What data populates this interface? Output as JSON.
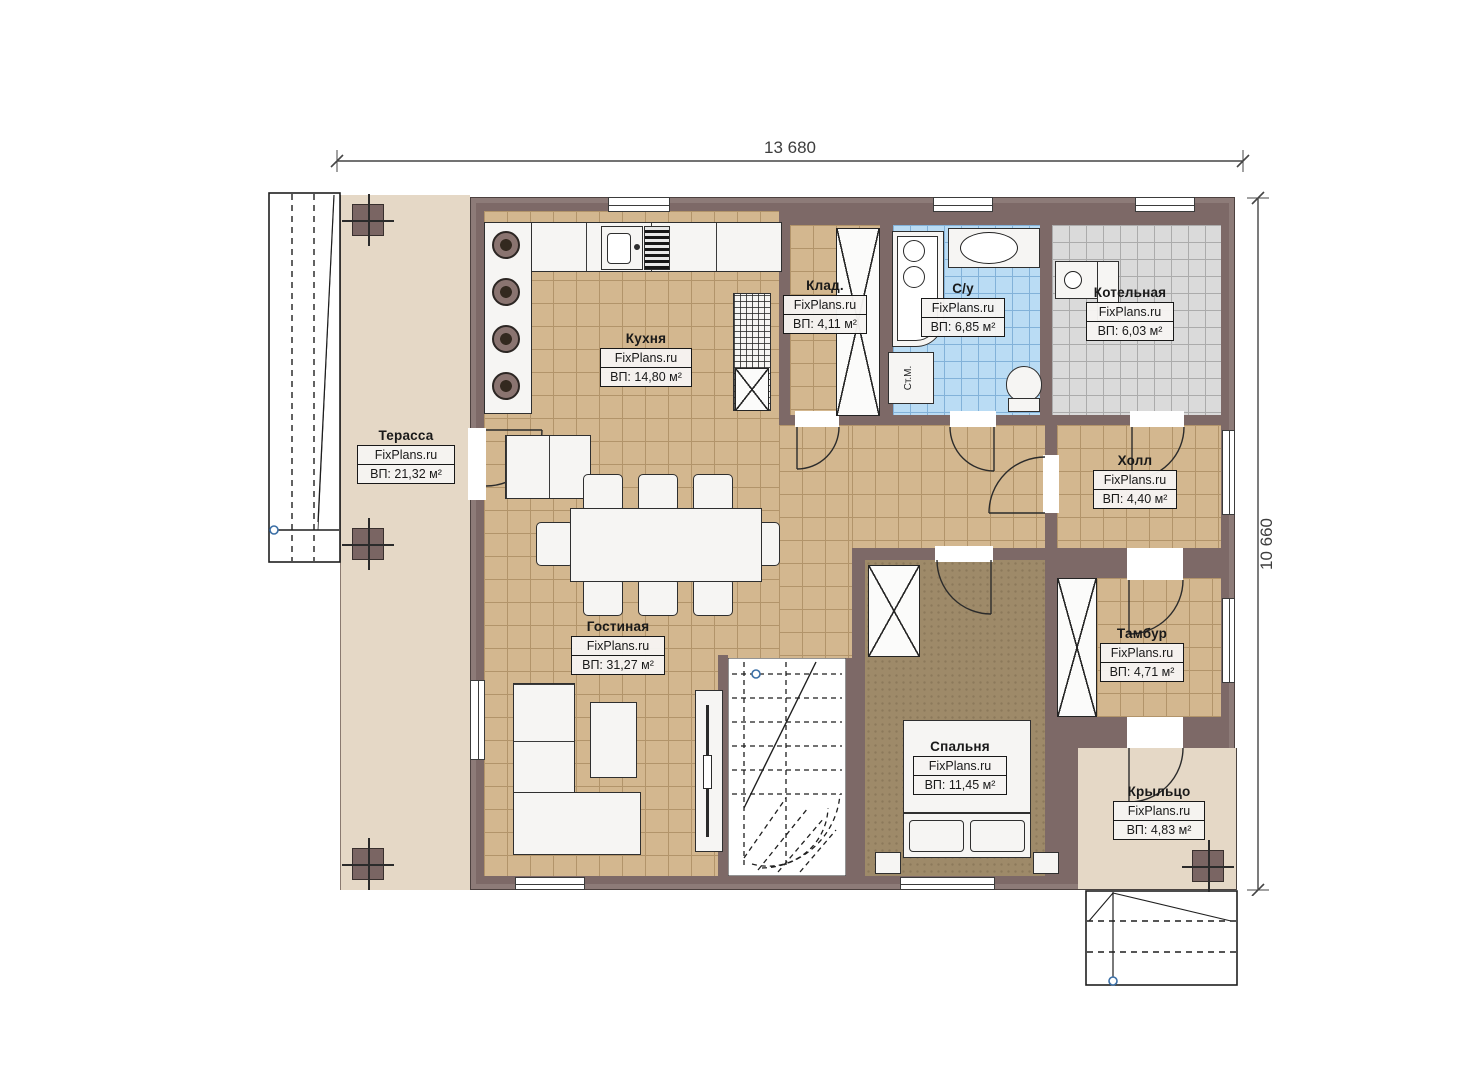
{
  "dims": {
    "width": "13 680",
    "height": "10 660"
  },
  "rooms": [
    {
      "id": "terrace",
      "name": "Терасса",
      "brand": "FixPlans.ru",
      "area": "ВП: 21,32 м²"
    },
    {
      "id": "kitchen",
      "name": "Кухня",
      "brand": "FixPlans.ru",
      "area": "ВП: 14,80 м²"
    },
    {
      "id": "storage",
      "name": "Клад.",
      "brand": "FixPlans.ru",
      "area": "ВП: 4,11 м²"
    },
    {
      "id": "bathroom",
      "name": "С/у",
      "brand": "FixPlans.ru",
      "area": "ВП: 6,85 м²"
    },
    {
      "id": "boiler",
      "name": "Котельная",
      "brand": "FixPlans.ru",
      "area": "ВП: 6,03 м²"
    },
    {
      "id": "hall",
      "name": "Холл",
      "brand": "FixPlans.ru",
      "area": "ВП: 4,40 м²"
    },
    {
      "id": "living",
      "name": "Гостиная",
      "brand": "FixPlans.ru",
      "area": "ВП: 31,27 м²"
    },
    {
      "id": "vestibule",
      "name": "Тамбур",
      "brand": "FixPlans.ru",
      "area": "ВП: 4,71 м²"
    },
    {
      "id": "bedroom",
      "name": "Спальня",
      "brand": "FixPlans.ru",
      "area": "ВП: 11,45 м²"
    },
    {
      "id": "porch",
      "name": "Крыльцо",
      "brand": "FixPlans.ru",
      "area": "ВП: 4,83 м²"
    }
  ],
  "labels": {
    "washing_machine": "Ст.М."
  },
  "colors": {
    "wall": "#7d6967",
    "tile": "#d3b78f",
    "bath_tile": "#badcf4",
    "boiler_tile": "#dadada",
    "wood": "#9e8a69",
    "terrace": "#e5d8c6"
  }
}
